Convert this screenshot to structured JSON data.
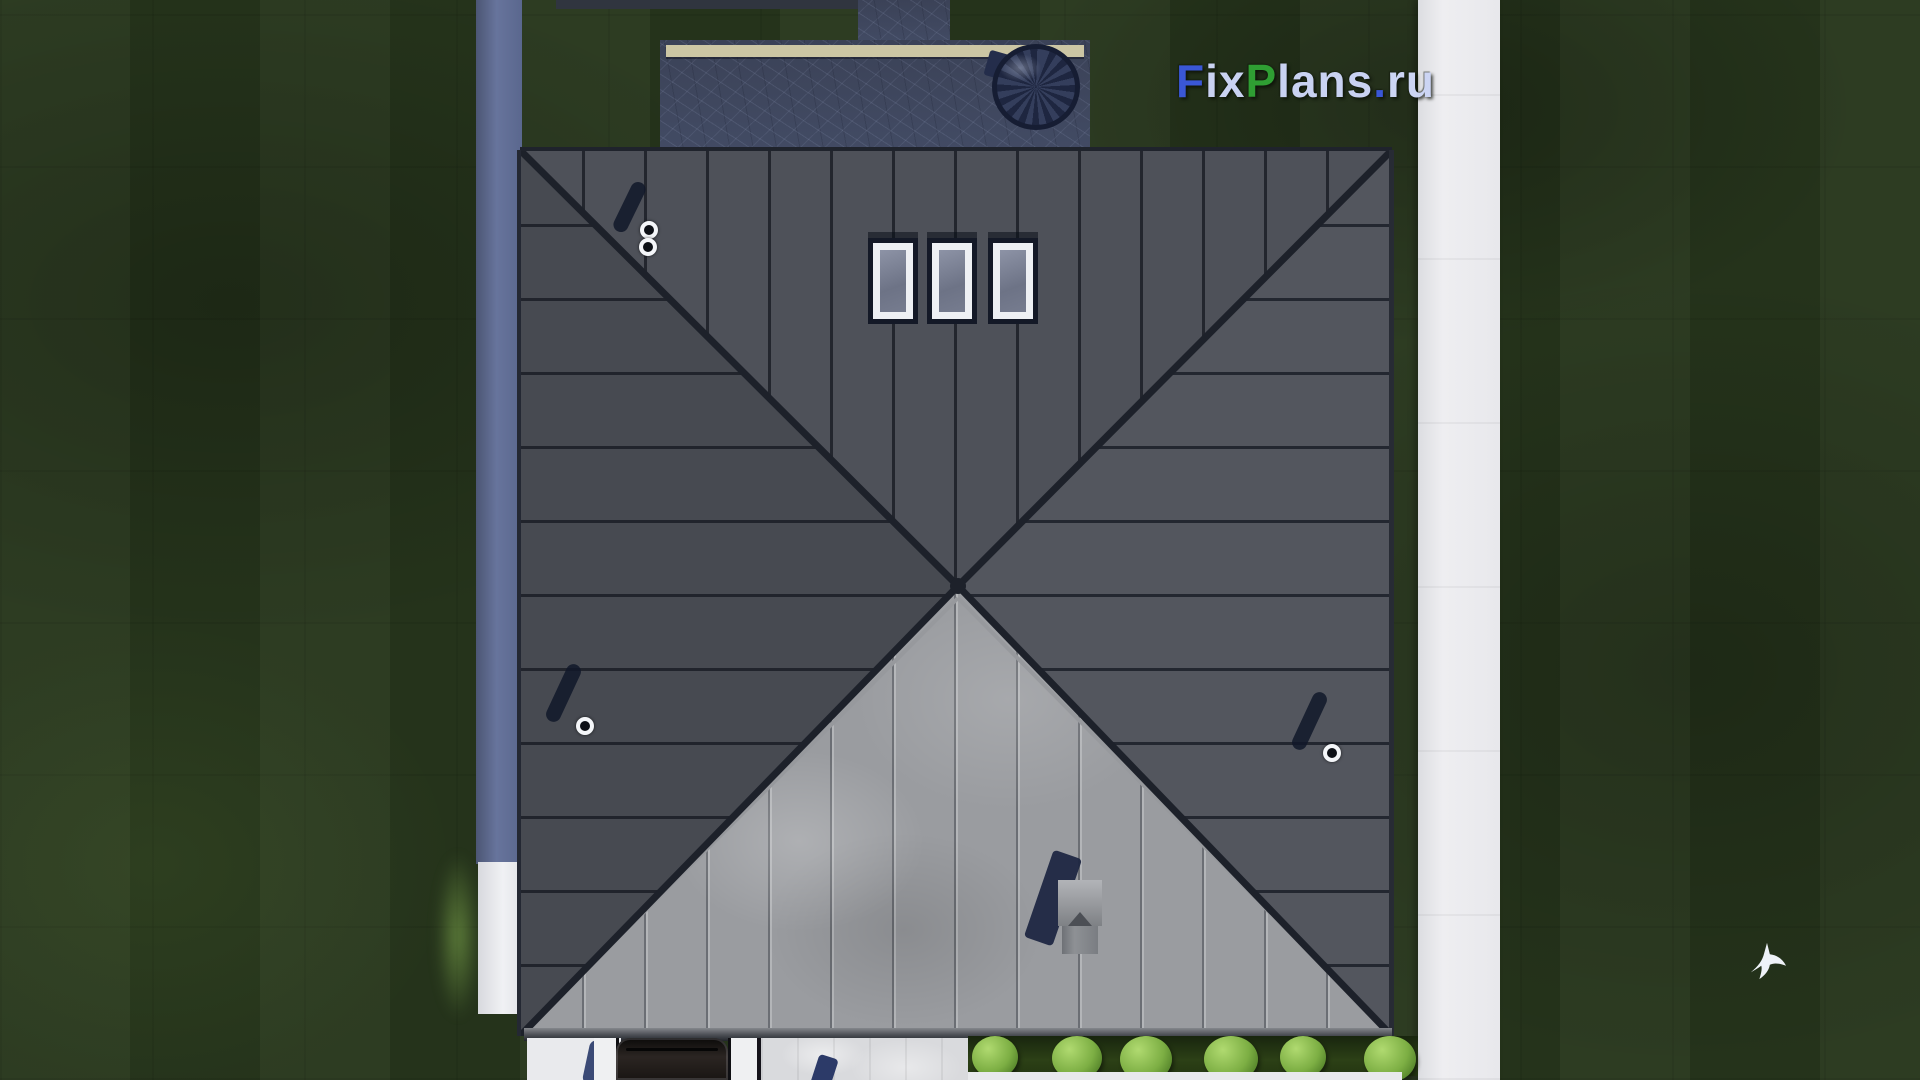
{
  "watermark": {
    "text": "FixPlans.ru",
    "parts": [
      {
        "text": "F",
        "color": "#3a57d6"
      },
      {
        "text": "ix",
        "color": "#c9d2f2"
      },
      {
        "text": "P",
        "color": "#2f9e33"
      },
      {
        "text": "lans",
        "color": "#c9d2f2"
      },
      {
        "text": ".",
        "color": "#3a57d6"
      },
      {
        "text": "ru",
        "color": "#ccd5f4"
      }
    ]
  },
  "palette": {
    "grass_dark": "#27361c",
    "roof_dark_top": "#4e5159",
    "roof_dark_left": "#474a51",
    "roof_dark_right": "#53565e",
    "roof_sunlit_front": "#9a9ca0",
    "seam_dark": "#23262e",
    "terrace_stone_blue": "#414a63",
    "bench_beige": "#ccc6a4",
    "wall_band_blue": "#67749c",
    "path_white": "#ededf0",
    "bush_green": "#7cae43",
    "vent_shadow_navy": "#1b2440"
  },
  "scene": {
    "description": "Top-down 3D render of a square hip-roof house with terrace, paths, hedge and lawn",
    "skylight_count": 3,
    "roof_vent_count": 3,
    "hedge_bush_count": 6,
    "bird_count": 1
  }
}
